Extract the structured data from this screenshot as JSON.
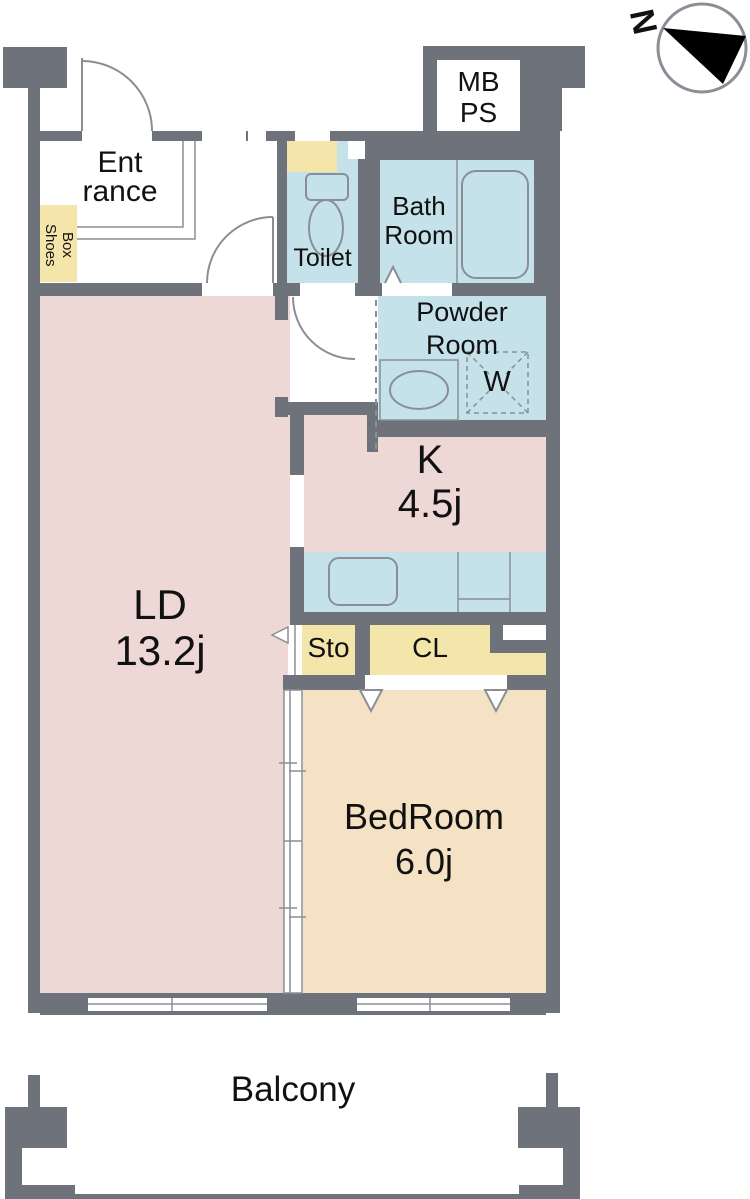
{
  "title": "Apartment floor plan 1LDK",
  "compass": {
    "label": "N"
  },
  "colors": {
    "wall": "#6e737b",
    "fixture_line": "#8a8f96",
    "living_pink": "#edd8d6",
    "wet_area_blue": "#c5e1e9",
    "storage_yellow": "#f4e5ab",
    "bedroom_beige": "#f5e2c4",
    "text": "#111111"
  },
  "rooms": {
    "entrance": {
      "line1": "Ent",
      "line2": "rance"
    },
    "shoes_box": {
      "line1": "Shoes",
      "line2": "Box"
    },
    "toilet": {
      "label": "Toilet"
    },
    "bath": {
      "line1": "Bath",
      "line2": "Room"
    },
    "meter_pipe_space": {
      "line1": "MB",
      "line2": "PS"
    },
    "powder": {
      "line1": "Powder",
      "line2": "Room"
    },
    "washer": {
      "label": "W"
    },
    "kitchen": {
      "label": "K",
      "size": "4.5j"
    },
    "living_dining": {
      "label": "LD",
      "size": "13.2j"
    },
    "storage": {
      "label": "Sto"
    },
    "closet": {
      "label": "CL"
    },
    "bedroom": {
      "label": "BedRoom",
      "size": "6.0j"
    },
    "balcony": {
      "label": "Balcony"
    }
  }
}
